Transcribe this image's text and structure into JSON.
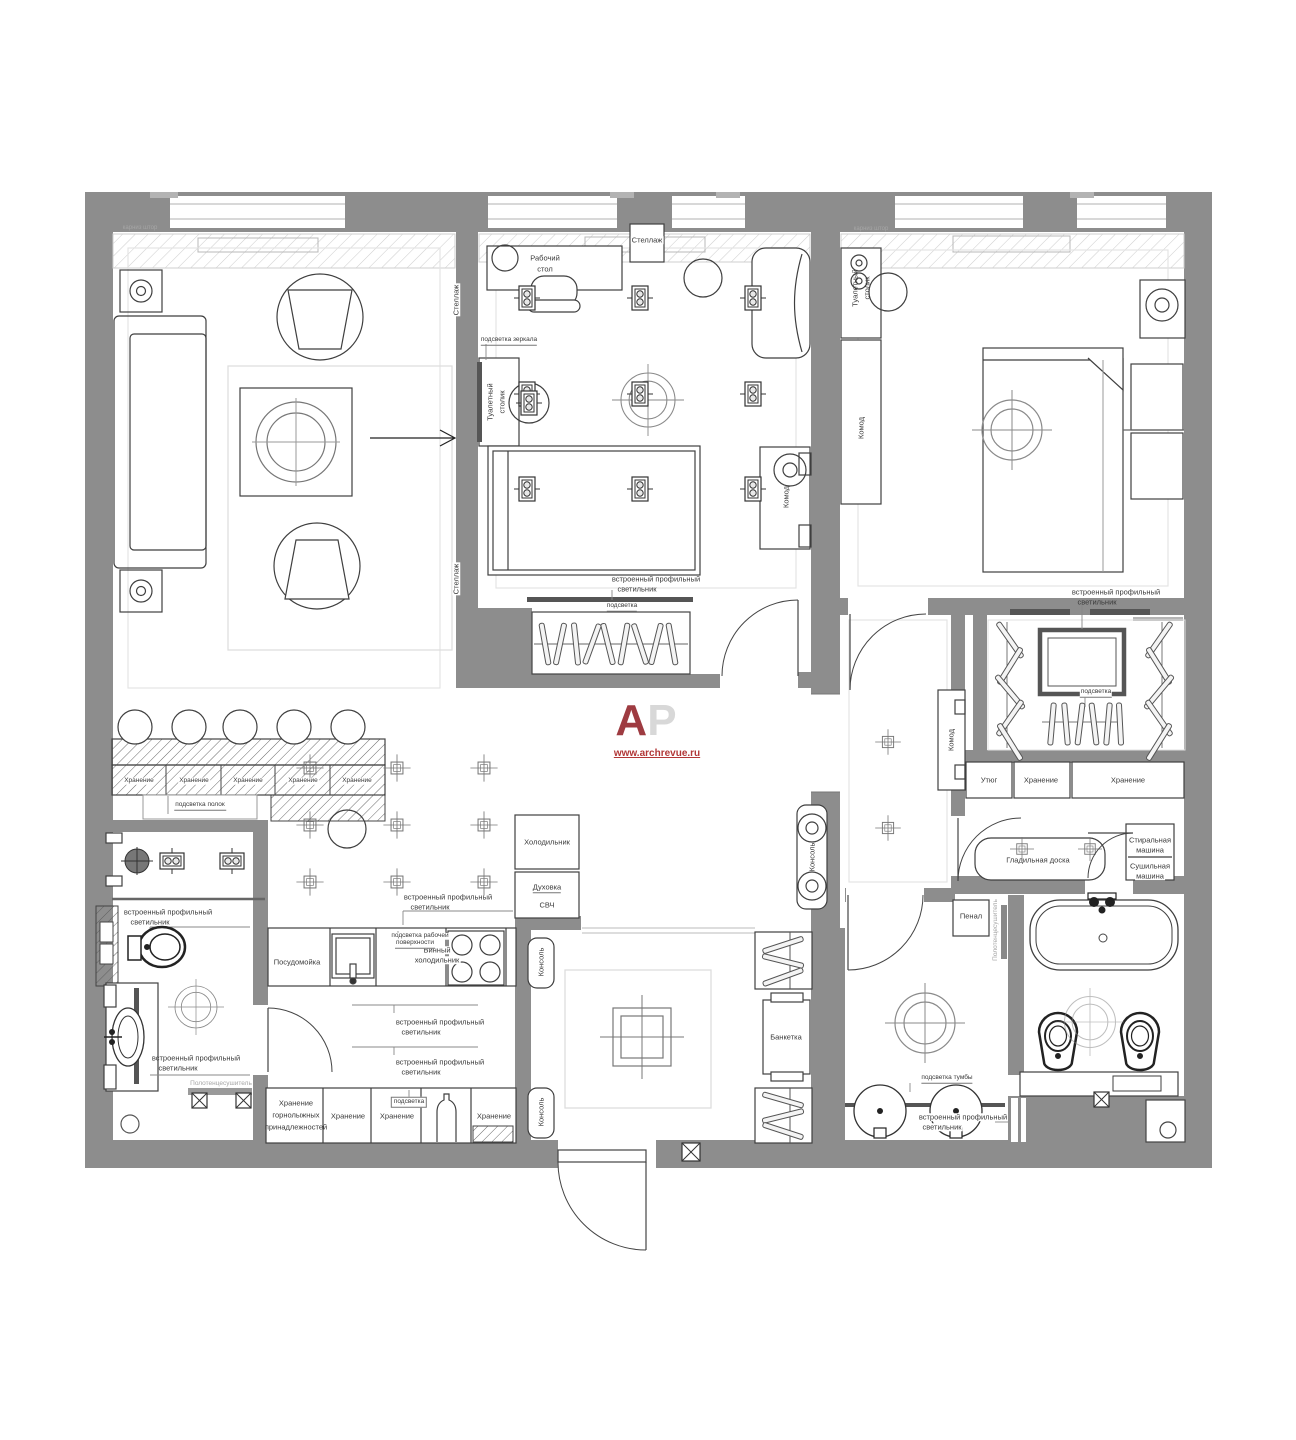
{
  "logo": {
    "letter_a": "A",
    "letter_p": "P",
    "site": "www.archrevue.ru"
  },
  "colors": {
    "wall": "#8d8d8d",
    "logo_red": "#9e3b41",
    "logo_gray": "#d8d8d8",
    "url_red": "#b23737"
  },
  "terms": {
    "shelf": "Стеллаж",
    "desk1": "Рабочий",
    "desk2": "стол",
    "mirror_light": "подсветка зеркала",
    "dressing1": "Туалетный",
    "dressing2": "столик",
    "chest": "Комод",
    "curtain": "карниз штор",
    "prof1": "встроенный профильный",
    "prof2": "светильник",
    "backlight": "подсветка",
    "shelves_light": "подсветка полок",
    "storage": "Хранение",
    "ski2": "горнолыжных",
    "ski3": "принадлежностей",
    "iron": "Утюг",
    "ironing_board": "Гладильная доска",
    "washing1": "Стиральная",
    "washing2": "машина",
    "drying1": "Сушильная",
    "console": "Консоль",
    "dishwasher": "Посудомойка",
    "wine1": "Винный",
    "wine2": "холодильник",
    "worktop1": "подсветка рабочей",
    "worktop2": "поверхности",
    "fridge": "Холодильник",
    "oven": "Духовка",
    "microwave": "СВЧ",
    "bench": "Банкетка",
    "penal": "Пенал",
    "towel_rail": "Полотенцесушитель",
    "vanity_light": "подсветка тумбы"
  }
}
